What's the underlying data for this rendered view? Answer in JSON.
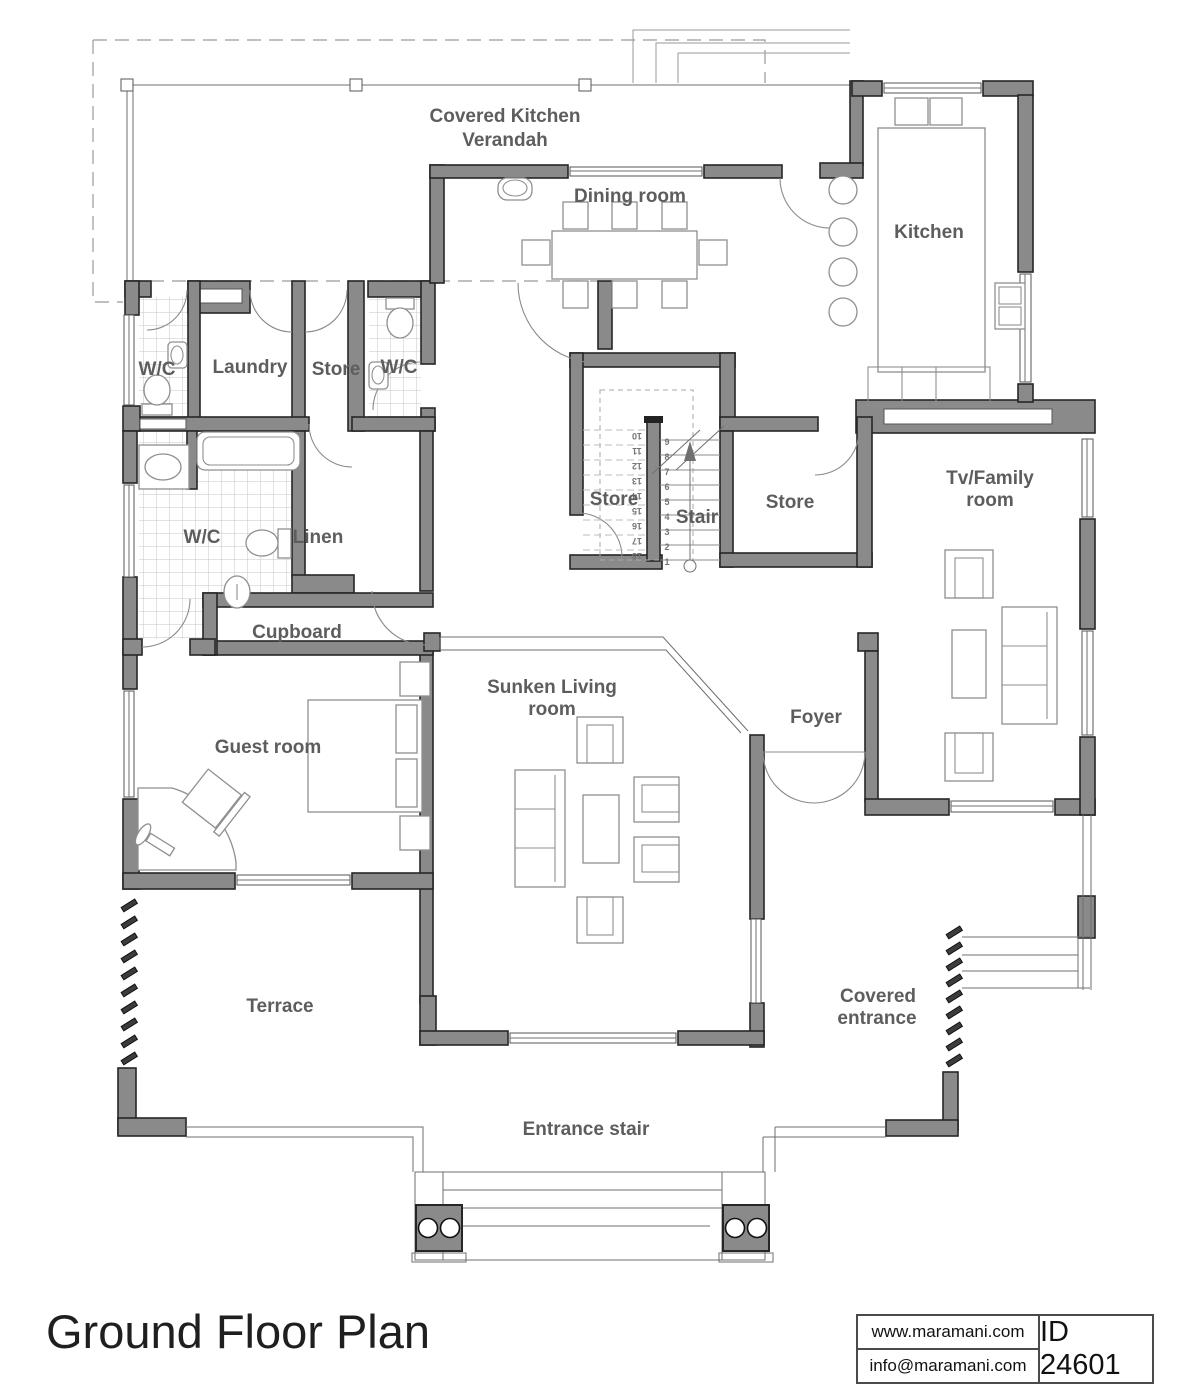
{
  "plan": {
    "rooms": {
      "covered_kitchen_verandah": {
        "line1": "Covered Kitchen",
        "line2": "Verandah"
      },
      "dining_room": "Dining room",
      "kitchen": "Kitchen",
      "wc_top_left": "W/C",
      "laundry": "Laundry",
      "store_top": "Store",
      "wc_top_right": "W/C",
      "wc_main": "W/C",
      "linen": "Linen",
      "cupboard": "Cupboard",
      "store_under_stair": "Store",
      "stair": "Stair",
      "store_right": "Store",
      "tv_family": {
        "line1": "Tv/Family",
        "line2": "room"
      },
      "sunken_living": {
        "line1": "Sunken Living",
        "line2": "room"
      },
      "foyer": "Foyer",
      "guest_room": "Guest room",
      "terrace": "Terrace",
      "covered_entrance": {
        "line1": "Covered",
        "line2": "entrance"
      },
      "entrance_stair": "Entrance stair"
    },
    "stair_numbers": [
      "1",
      "2",
      "3",
      "4",
      "5",
      "6",
      "7",
      "8",
      "9",
      "10",
      "11",
      "12",
      "13",
      "14",
      "15",
      "16",
      "17",
      "18"
    ]
  },
  "footer": {
    "title": "Ground Floor Plan",
    "website": "www.maramani.com",
    "email": "info@maramani.com",
    "plan_id": "ID 24601"
  },
  "colors": {
    "wall": "#8a8a8a",
    "label": "#5d5d5d",
    "line": "#6f6f6f"
  }
}
